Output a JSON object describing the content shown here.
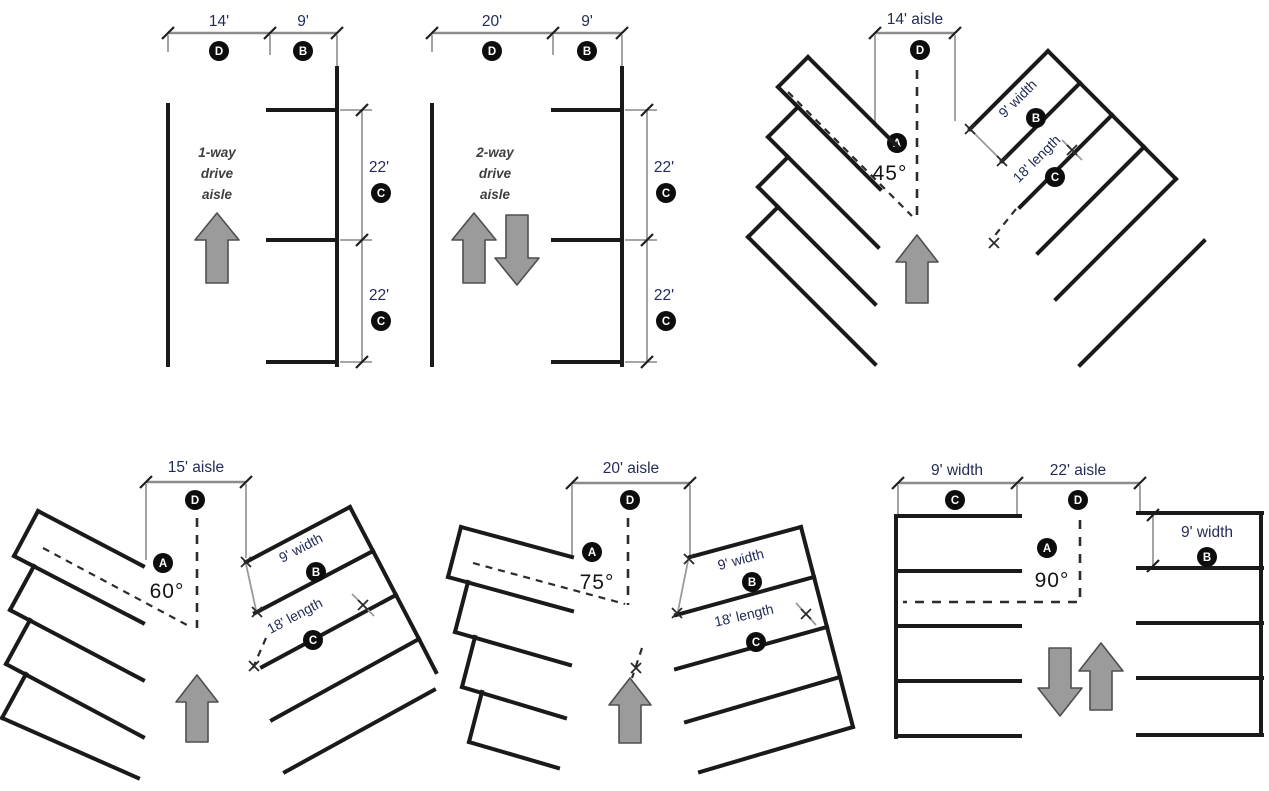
{
  "figure": {
    "title": "Parking aisle and stall dimension diagrams",
    "colors": {
      "line": "#1a1a1a",
      "dimension_line": "#8c8c8c",
      "dimension_text": "#232c55",
      "angle_text": "#141414",
      "aisle_text": "#3f3f3f",
      "arrow_fill": "#9b9b9b",
      "arrow_stroke": "#4f4f4f",
      "badge_background": "#0d0d0d",
      "badge_letter": "#ffffff"
    }
  },
  "panels": {
    "one_way": {
      "aisle_width_label": "14'",
      "stall_width_label": "9'",
      "stall_length_top_label": "22'",
      "stall_length_bottom_label": "22'",
      "aisle_text_lines": [
        "1-way",
        "drive",
        "aisle"
      ],
      "badges": {
        "aisle_width": "D",
        "stall_width": "B",
        "stall_length_top": "C",
        "stall_length_bottom": "C"
      }
    },
    "two_way": {
      "aisle_width_label": "20'",
      "stall_width_label": "9'",
      "stall_length_top_label": "22'",
      "stall_length_bottom_label": "22'",
      "aisle_text_lines": [
        "2-way",
        "drive",
        "aisle"
      ],
      "badges": {
        "aisle_width": "D",
        "stall_width": "B",
        "stall_length_top": "C",
        "stall_length_bottom": "C"
      }
    },
    "angle_45": {
      "aisle_label": "14' aisle",
      "angle_label": "45°",
      "stall_width_label": "9' width",
      "stall_length_label": "18' length",
      "badges": {
        "aisle": "D",
        "angle": "A",
        "width": "B",
        "length": "C"
      }
    },
    "angle_60": {
      "aisle_label": "15' aisle",
      "angle_label": "60°",
      "stall_width_label": "9' width",
      "stall_length_label": "18' length",
      "badges": {
        "aisle": "D",
        "angle": "A",
        "width": "B",
        "length": "C"
      }
    },
    "angle_75": {
      "aisle_label": "20' aisle",
      "angle_label": "75°",
      "stall_width_label": "9' width",
      "stall_length_label": "18' length",
      "badges": {
        "aisle": "D",
        "angle": "A",
        "width": "B",
        "length": "C"
      }
    },
    "angle_90": {
      "left_width_label": "9' width",
      "aisle_label": "22' aisle",
      "right_width_label": "9' width",
      "angle_label": "90°",
      "badges": {
        "left_width": "C",
        "aisle": "D",
        "right_width": "B",
        "angle": "A"
      }
    }
  }
}
